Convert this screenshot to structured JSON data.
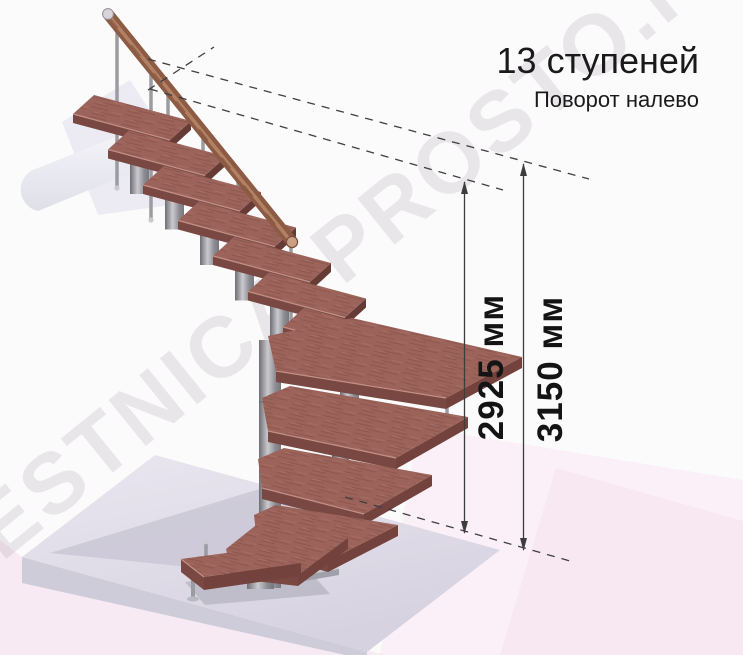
{
  "header": {
    "title": "13 ступеней",
    "subtitle": "Поворот налево"
  },
  "dimensions": {
    "to_top_step": {
      "label": "2925 мм"
    },
    "floor_to_floor": {
      "label": "3150 мм"
    }
  },
  "watermark": {
    "text": "LESTNICA-PROSTO.RU"
  },
  "staircase": {
    "steps_count": 13,
    "turn_direction": "налево"
  },
  "colors": {
    "tread_top": "#9b635a",
    "tread_edge": "#7a4842",
    "metal": "#9b9ba2",
    "handrail": "#8d5a44",
    "floor_slab": "#dfdce7",
    "background_pink": "#f8eaf2",
    "dimension_line": "#3d3d3d",
    "text": "#1a1a1a"
  }
}
